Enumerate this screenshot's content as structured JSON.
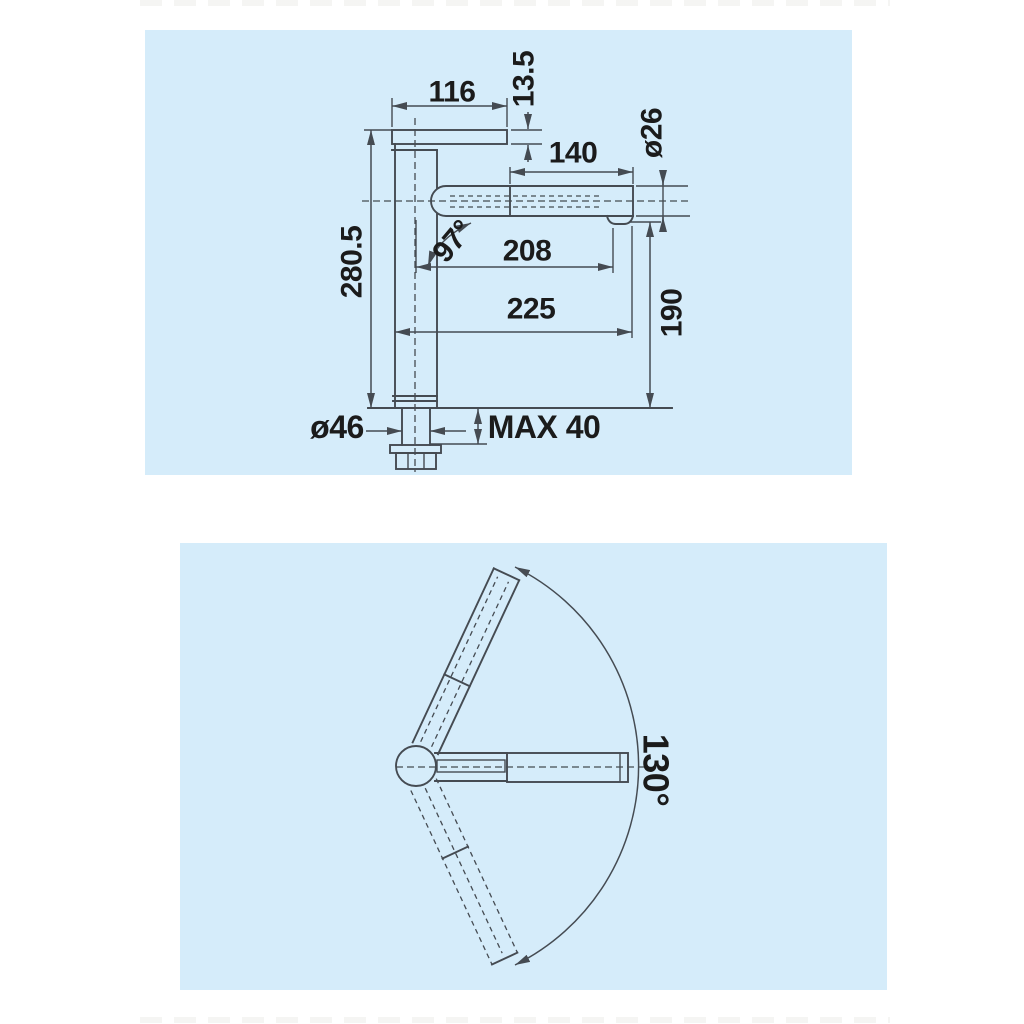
{
  "colors": {
    "panel": "#d5ecfa",
    "line": "#454b52",
    "text": "#1b1b1b",
    "page_bg": "#ffffff"
  },
  "side_view": {
    "title": "faucet side elevation with dimensions",
    "labels": {
      "lever_length": "116",
      "lever_thickness": "13.5",
      "spout_section_length": "140",
      "spout_diameter": "ø26",
      "total_height": "280.5",
      "spout_angle": "97°",
      "projection_aerator": "208",
      "projection_total": "225",
      "spout_height": "190",
      "base_diameter": "ø46",
      "max_deck_thickness": "MAX 40"
    }
  },
  "top_view": {
    "title": "faucet plan view swivel range",
    "labels": {
      "swivel_range": "130°"
    }
  }
}
